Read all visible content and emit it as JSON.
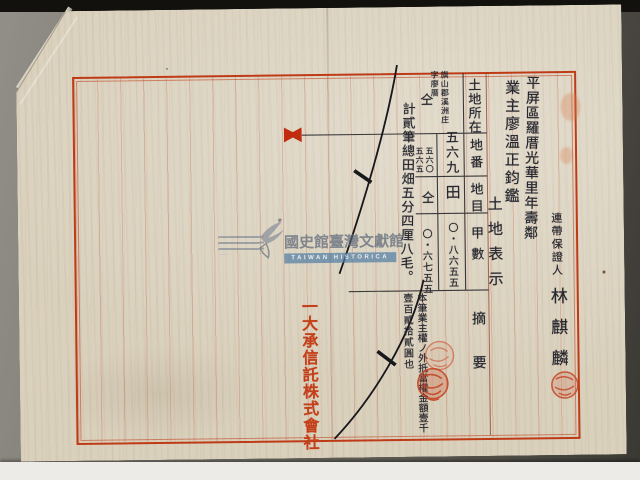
{
  "colors": {
    "paper": "#dad1bd",
    "frame_red": "#bf3a16",
    "ink_black": "#26262e",
    "seal_red": "#c7452a",
    "watermark_blue": "#4d7ba3"
  },
  "watermark": {
    "zh": "國史館臺灣文獻館",
    "en": "TAIWAN HISTORICA"
  },
  "publisher": {
    "prefix": "一",
    "company": "大承信託株式會社"
  },
  "letter": {
    "address_column": "平屏區羅厝光華里年壽鄰",
    "addressee_column": "業主廖溫正鈞鑑",
    "section_title": "土地表示",
    "guarantor_label": "連帶保證人",
    "guarantor_name": "林麒麟"
  },
  "table": {
    "headers": {
      "location": "土地所在",
      "lot": "地番",
      "category": "地目",
      "area": "甲數",
      "summary": "摘要"
    },
    "entries": [
      {
        "location_line1": "旗山郡溪洲庄",
        "location_line2": "字廖厝",
        "lot": "五六九",
        "category": "田",
        "area": "〇・八六五五"
      },
      {
        "location": "仝",
        "lot_line1": "五六〇",
        "lot_line2": "五六五",
        "category": "仝",
        "area": "〇・六七五五"
      }
    ],
    "total_note": "計貳筆總田畑五分四厘八毛。",
    "summary_note_line1": "本筆業主權ノ外抵當權金額壹千",
    "summary_note_line2": "壹百貳拾貳圓也"
  }
}
